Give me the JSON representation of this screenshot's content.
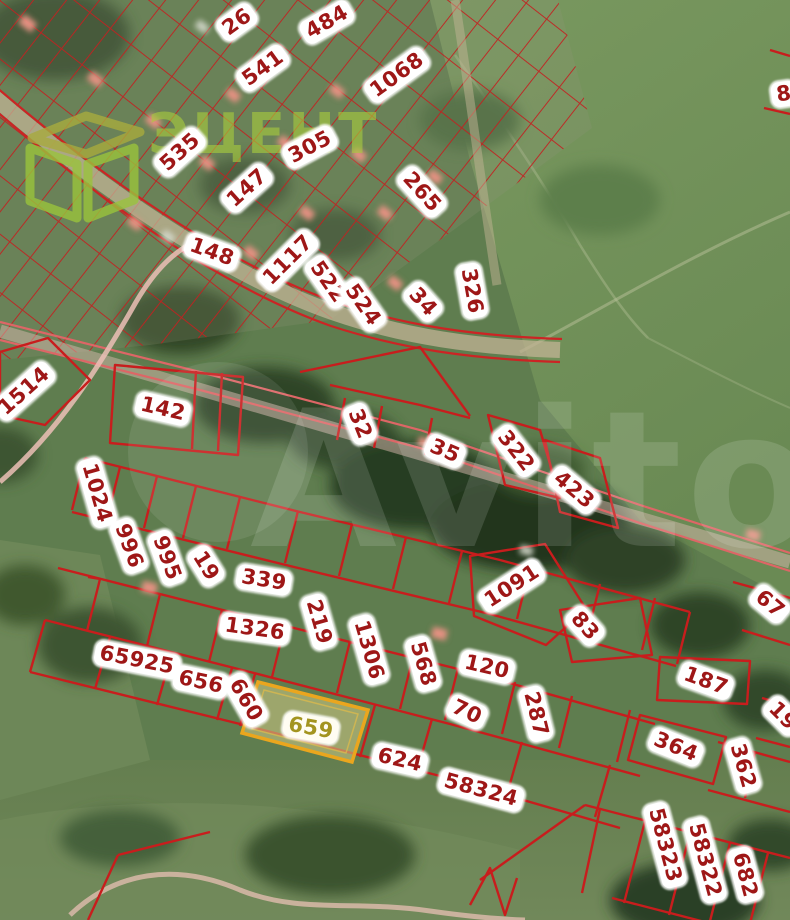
{
  "map": {
    "type": "cadastral-satellite-map",
    "watermark": "Avito",
    "logo": {
      "text": "ЭЦЕНТ",
      "icon": "cube-logo-icon",
      "color": "#a8cb3d"
    },
    "highlighted_parcel": "659",
    "colors": {
      "boundary_red": "#c81d1d",
      "label_text": "#9e1717",
      "label_bg": "#ffffff",
      "highlight_fill": "#c6c180",
      "highlight_border": "#eaa61e",
      "highlight_text": "#a3941f",
      "road_pink": "#ecc0b6",
      "road_tan": "#c2b394"
    },
    "parcels": [
      {
        "n": "26",
        "x": 237,
        "y": 22,
        "r": -36
      },
      {
        "n": "541",
        "x": 263,
        "y": 68,
        "r": -36
      },
      {
        "n": "484",
        "x": 327,
        "y": 22,
        "r": -30
      },
      {
        "n": "1068",
        "x": 397,
        "y": 75,
        "r": -36
      },
      {
        "n": "535",
        "x": 180,
        "y": 152,
        "r": -42
      },
      {
        "n": "305",
        "x": 310,
        "y": 147,
        "r": -28
      },
      {
        "n": "147",
        "x": 247,
        "y": 188,
        "r": -42
      },
      {
        "n": "265",
        "x": 422,
        "y": 192,
        "r": 48
      },
      {
        "n": "148",
        "x": 212,
        "y": 252,
        "r": 20
      },
      {
        "n": "1117",
        "x": 288,
        "y": 260,
        "r": -45
      },
      {
        "n": "522",
        "x": 328,
        "y": 282,
        "r": 55
      },
      {
        "n": "524",
        "x": 363,
        "y": 305,
        "r": 55
      },
      {
        "n": "34",
        "x": 423,
        "y": 302,
        "r": 48
      },
      {
        "n": "326",
        "x": 472,
        "y": 291,
        "r": 80
      },
      {
        "n": "8",
        "x": 784,
        "y": 94,
        "r": -8
      },
      {
        "n": "1514",
        "x": 24,
        "y": 391,
        "r": -42
      },
      {
        "n": "142",
        "x": 163,
        "y": 409,
        "r": 13
      },
      {
        "n": "32",
        "x": 360,
        "y": 424,
        "r": 68
      },
      {
        "n": "35",
        "x": 445,
        "y": 451,
        "r": 23
      },
      {
        "n": "322",
        "x": 516,
        "y": 451,
        "r": 52
      },
      {
        "n": "423",
        "x": 574,
        "y": 490,
        "r": 40
      },
      {
        "n": "1024",
        "x": 97,
        "y": 493,
        "r": 74
      },
      {
        "n": "996",
        "x": 129,
        "y": 546,
        "r": 70
      },
      {
        "n": "995",
        "x": 167,
        "y": 558,
        "r": 70
      },
      {
        "n": "19",
        "x": 206,
        "y": 566,
        "r": 58
      },
      {
        "n": "339",
        "x": 264,
        "y": 580,
        "r": 9
      },
      {
        "n": "1326",
        "x": 255,
        "y": 629,
        "r": 8
      },
      {
        "n": "219",
        "x": 319,
        "y": 622,
        "r": 74
      },
      {
        "n": "1306",
        "x": 369,
        "y": 650,
        "r": 74
      },
      {
        "n": "1091",
        "x": 512,
        "y": 586,
        "r": -33
      },
      {
        "n": "83",
        "x": 585,
        "y": 626,
        "r": 48
      },
      {
        "n": "568",
        "x": 423,
        "y": 664,
        "r": 74
      },
      {
        "n": "120",
        "x": 487,
        "y": 667,
        "r": 13
      },
      {
        "n": "70",
        "x": 467,
        "y": 712,
        "r": 25
      },
      {
        "n": "287",
        "x": 536,
        "y": 714,
        "r": 76
      },
      {
        "n": "67",
        "x": 770,
        "y": 604,
        "r": 40
      },
      {
        "n": "187",
        "x": 706,
        "y": 681,
        "r": 20
      },
      {
        "n": "19",
        "x": 783,
        "y": 716,
        "r": 45
      },
      {
        "n": "364",
        "x": 676,
        "y": 747,
        "r": 22
      },
      {
        "n": "362",
        "x": 743,
        "y": 766,
        "r": 74
      },
      {
        "n": "65925",
        "x": 137,
        "y": 660,
        "r": 11
      },
      {
        "n": "656",
        "x": 201,
        "y": 682,
        "r": 12
      },
      {
        "n": "660",
        "x": 246,
        "y": 700,
        "r": 60
      },
      {
        "n": "659",
        "x": 311,
        "y": 728,
        "r": 10,
        "hl": true
      },
      {
        "n": "624",
        "x": 400,
        "y": 760,
        "r": 13
      },
      {
        "n": "58324",
        "x": 481,
        "y": 790,
        "r": 15
      },
      {
        "n": "58323",
        "x": 665,
        "y": 845,
        "r": 75
      },
      {
        "n": "58322",
        "x": 705,
        "y": 860,
        "r": 75
      },
      {
        "n": "682",
        "x": 745,
        "y": 875,
        "r": 75
      }
    ]
  }
}
